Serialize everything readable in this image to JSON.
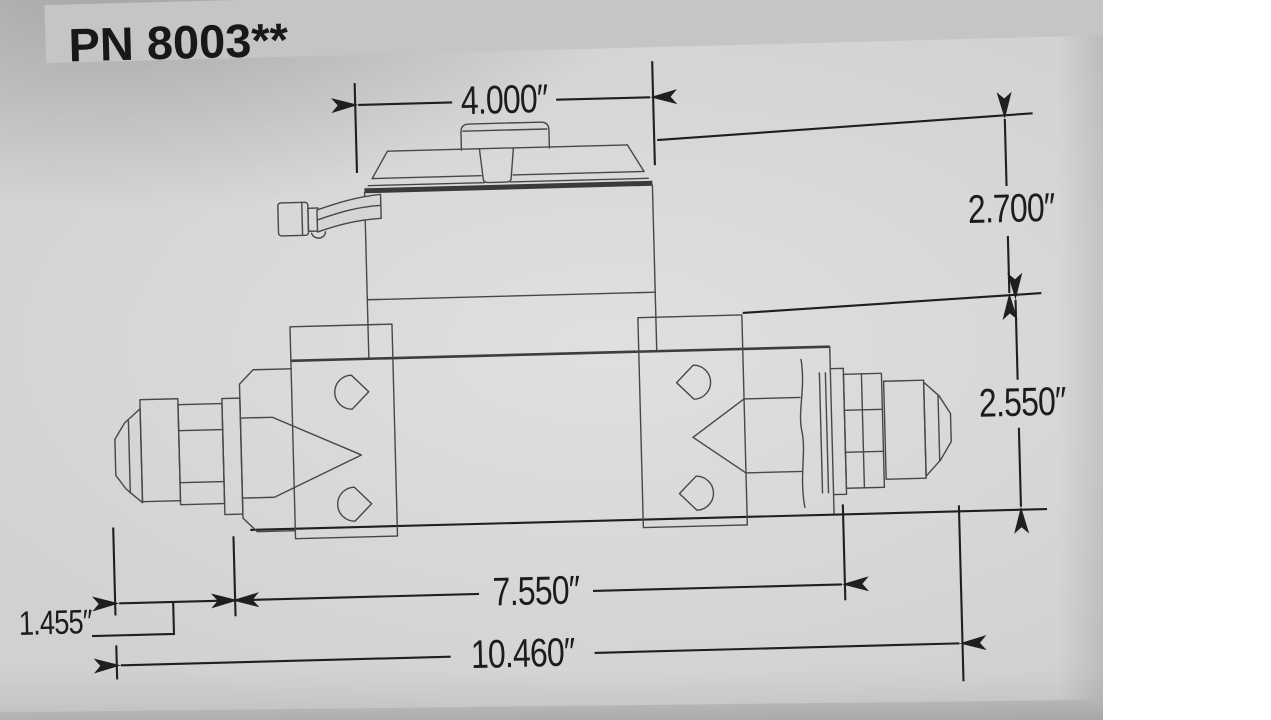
{
  "page": {
    "part_number": "PN 8003**",
    "figure": "Electric fuel pump side-view technical line drawing with dimension callouts"
  },
  "dimensions": {
    "top_width": "4.000″",
    "upper_height": "2.700″",
    "lower_height": "2.550″",
    "body_length": "7.550″",
    "fitting_length": "1.455″",
    "overall_length": "10.460″"
  },
  "colors": {
    "page_gray": "#d2d1cf",
    "banner_gray": "#c6c5c3",
    "drawing_line": "#474747",
    "dimension_ink": "#1f1f1f",
    "page_edge_shadow": "#a5a4a2",
    "margin_white": "#ffffff"
  }
}
